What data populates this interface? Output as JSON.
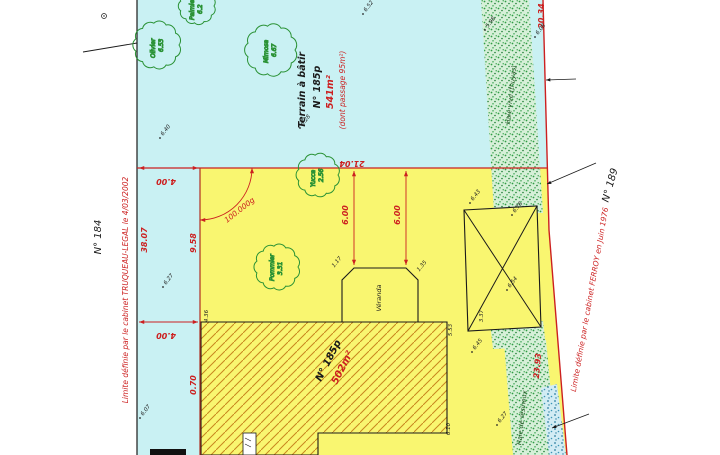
{
  "drawing": {
    "terrain_label": {
      "l1": "Terrain à bâtir",
      "l2": "N° 185p",
      "area": "541m²",
      "note": "(dont passage 95m²)"
    },
    "parcel_hatched": {
      "number": "N° 185p",
      "area": "502m²"
    },
    "neighbors": {
      "left": "N° 184",
      "right": "N° 189"
    },
    "limits": {
      "left": "Limite définie par le cabinet TRUQUEAU-LEGAL le 4/03/2002",
      "right": "Limite définie par le cabinet FERROY en Juin 1976"
    },
    "hedges": {
      "top": "Haie vive (thuyas)",
      "bottom": "Haie de résineux"
    },
    "veranda": "Véranda",
    "angle": "100.000g",
    "dims": {
      "top_offset": "4.00",
      "left_length": "38.07",
      "parcel_left_upper": "9.58",
      "mid_offset": "4.00",
      "parcel_left_lower": "0.70",
      "parcel_top_width": "21.04",
      "veranda_offset_left": "6.00",
      "veranda_offset_right": "6.00",
      "right_upper": "20.34",
      "right_lower": "23.93"
    },
    "small_dims": [
      {
        "v": "4.36"
      },
      {
        "v": "1.17"
      },
      {
        "v": "1.35"
      },
      {
        "v": "5.53"
      },
      {
        "v": "6.10"
      },
      {
        "v": "3.37"
      }
    ],
    "trees": [
      {
        "name": "Olivier",
        "h": "6.53"
      },
      {
        "name": "Palmier",
        "h": "6.2"
      },
      {
        "name": "Mimosa",
        "h": "6.67"
      },
      {
        "name": "Yucca",
        "h": "2.56"
      },
      {
        "name": "Pommier",
        "h": "3.31"
      }
    ],
    "spots": [
      {
        "v": "6.52"
      },
      {
        "v": "5.98"
      },
      {
        "v": "6.08"
      },
      {
        "v": "6.28"
      },
      {
        "v": "6.40"
      },
      {
        "v": "6.43"
      },
      {
        "v": "6.78"
      },
      {
        "v": "6.54"
      },
      {
        "v": "6.45"
      },
      {
        "v": "6.27"
      },
      {
        "v": "6.07"
      },
      {
        "v": "6.27"
      }
    ],
    "colors": {
      "cyan_parcel": "#c9f1f3",
      "yellow_parcel": "#f9f670",
      "hatch": "#c8861e",
      "boundary_red": "#cc2020",
      "hedge_green": "#2f9e44"
    }
  }
}
